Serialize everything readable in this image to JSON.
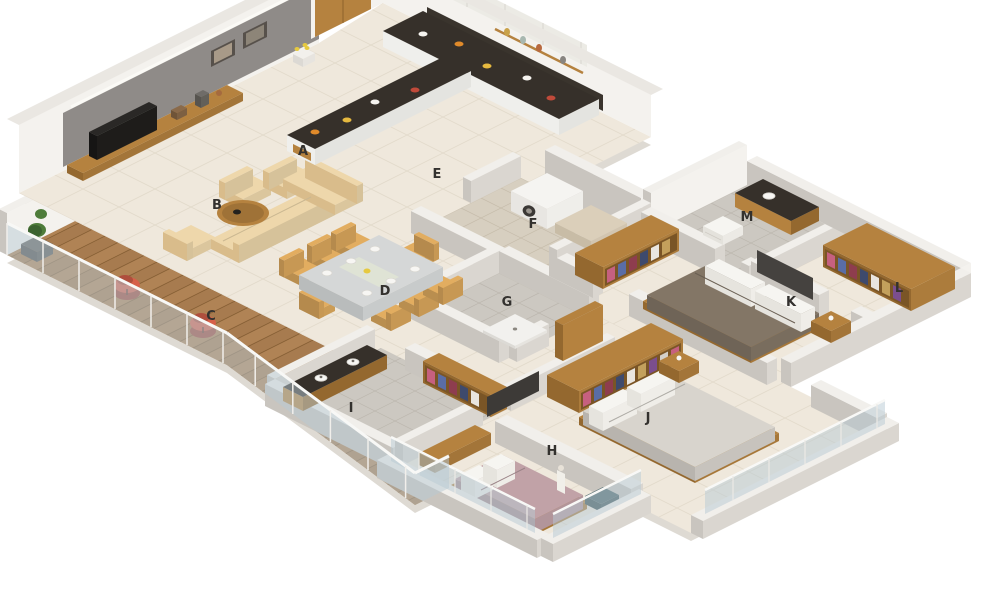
{
  "scene": {
    "description": "3D isometric rendering of a 3-bedroom apartment floor plan with rooms marked by letters",
    "background": "#ffffff"
  },
  "palette": {
    "floor_cream": "#efe8dc",
    "floor_cream_line": "#e2dacb",
    "floor_tile": "#ccc8c1",
    "floor_tile_line": "#bcb7af",
    "floor_utility": "#d7cfc0",
    "deck_wood": "#b08355",
    "deck_wood_line": "#8a6238",
    "wall_top": "#f1efeb",
    "wall_side": "#c9c5bf",
    "wall_side2": "#dad6d0",
    "facade_white": "#f4f2ee",
    "accent_wall": "#8f8b88",
    "cove": "#fbfaf6",
    "counter_dark": "#36302a",
    "wood": "#b5823f",
    "wood_dark": "#94682f",
    "sofa": "#eed7ab",
    "sofa_shade": "#d9bc8b",
    "chair_tan": "#e2ad60",
    "table_top": "#d5d7d7",
    "red_chair": "#d6604a",
    "plant": "#4e7c3a",
    "plant_dark": "#3c6330",
    "pot": "#63605c",
    "washer": "#f5f4f1",
    "washer_door": "#3b3835",
    "bed_h": "#c1a2a7",
    "bed_j": "#d8d4cd",
    "bed_k": "#837666",
    "pillow": "#f6f5f1",
    "tv_dark": "#23211e",
    "panel_dark": "#45423f",
    "glass": "rgba(183,201,212,0.5)",
    "glass_rail": "#f8f8f6",
    "shadow": "#dedad3",
    "label": "#33312e",
    "clothes": [
      "#c6607f",
      "#5a6da6",
      "#8e3d4e",
      "#3e4a6d",
      "#e9e5df",
      "#c3a05c",
      "#7b4e8e",
      "#d4d0c9"
    ]
  },
  "floorplan": {
    "room_labels": [
      {
        "id": "A",
        "x": 303,
        "y": 155
      },
      {
        "id": "B",
        "x": 217,
        "y": 209
      },
      {
        "id": "C",
        "x": 211,
        "y": 320
      },
      {
        "id": "D",
        "x": 385,
        "y": 295
      },
      {
        "id": "E",
        "x": 437,
        "y": 178
      },
      {
        "id": "F",
        "x": 533,
        "y": 228
      },
      {
        "id": "G",
        "x": 507,
        "y": 306
      },
      {
        "id": "H",
        "x": 552,
        "y": 455
      },
      {
        "id": "I",
        "x": 351,
        "y": 412
      },
      {
        "id": "J",
        "x": 648,
        "y": 422
      },
      {
        "id": "K",
        "x": 791,
        "y": 306
      },
      {
        "id": "L",
        "x": 899,
        "y": 292
      },
      {
        "id": "M",
        "x": 747,
        "y": 221
      }
    ]
  }
}
